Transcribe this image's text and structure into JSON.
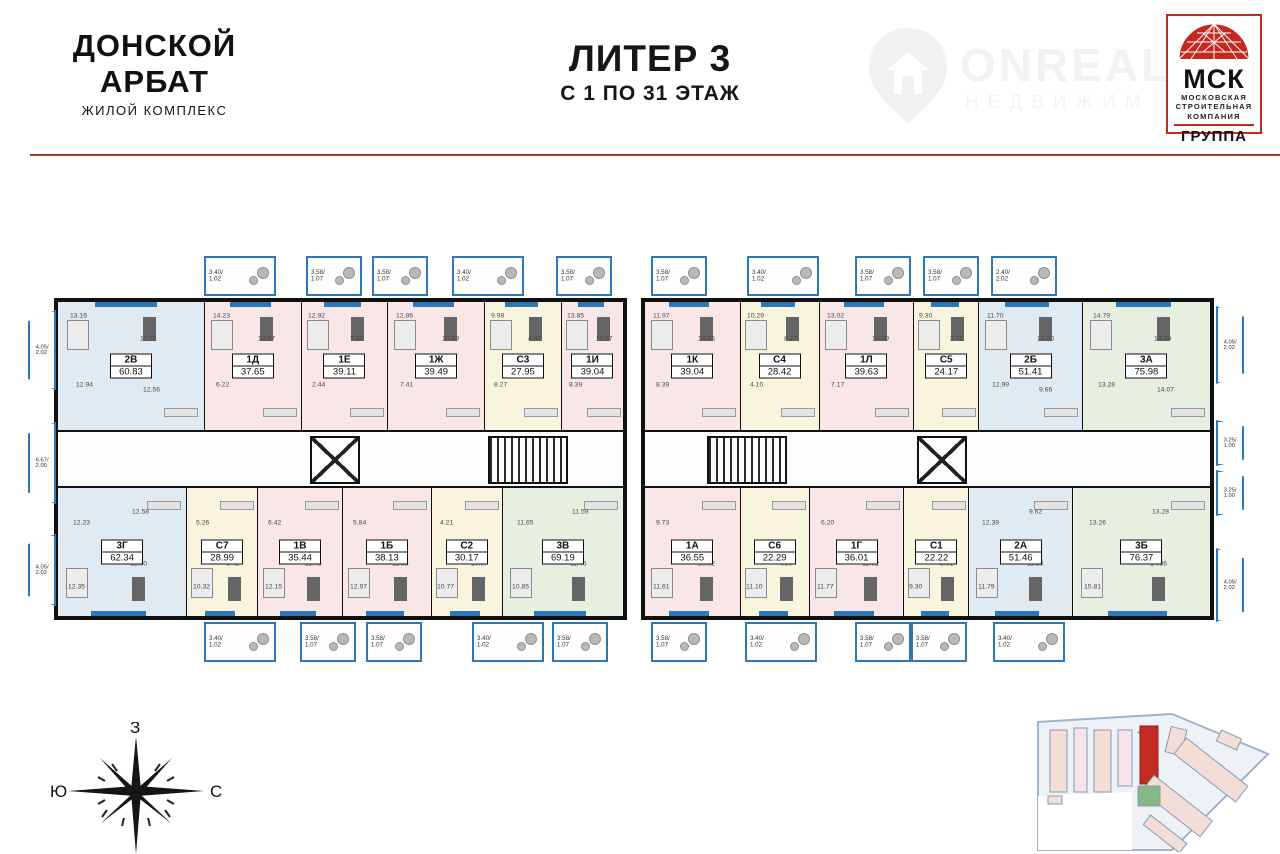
{
  "header": {
    "brand": {
      "line1": "ДОНСКОЙ",
      "line2": "АРБАТ",
      "subtitle": "ЖИЛОЙ КОМПЛЕКС"
    },
    "title": {
      "main": "ЛИТЕР 3",
      "sub": "С 1 ПО 31 ЭТАЖ"
    },
    "watermark": {
      "big": "ONREAL",
      "small": "НЕДВИЖИМ"
    },
    "msk": {
      "abbr": "МСК",
      "line1": "МОСКОВСКАЯ",
      "line2": "СТРОИТЕЛЬНАЯ",
      "line3": "КОМПАНИЯ",
      "group": "ГРУППА"
    }
  },
  "floorplan": {
    "accent_wall": "#111111",
    "window_color": "#2b77b8",
    "unit_colors": {
      "one_room": "#f9e6e6",
      "two_room": "#dfeaf2",
      "studio": "#f9f4dd",
      "three_room": "#e7f0e0"
    },
    "wings": [
      {
        "side": "left",
        "top_units": [
          {
            "code": "2В",
            "area": "60.83",
            "color": "#dfeaf2",
            "rooms": [
              "13.16",
              "11.55",
              "12.94",
              "12.56"
            ]
          },
          {
            "code": "1Д",
            "area": "37.65",
            "color": "#f9e6e6",
            "rooms": [
              "14.23",
              "12.07",
              "6.22"
            ]
          },
          {
            "code": "1Е",
            "area": "39.11",
            "color": "#f9e6e6",
            "rooms": [
              "12.92",
              "7.40",
              "2.44"
            ]
          },
          {
            "code": "1Ж",
            "area": "39.49",
            "color": "#f9e6e6",
            "rooms": [
              "12.86",
              "10.89",
              "7.41"
            ]
          },
          {
            "code": "С3",
            "area": "27.95",
            "color": "#f9f4dd",
            "rooms": [
              "9.98",
              "4.37",
              "8.27"
            ]
          },
          {
            "code": "1И",
            "area": "39.04",
            "color": "#f9e6e6",
            "rooms": [
              "13.85",
              "11.97",
              "8.39"
            ]
          }
        ],
        "bottom_units": [
          {
            "code": "3Г",
            "area": "62.34",
            "color": "#dfeaf2",
            "rooms": [
              "12.35",
              "12.80",
              "12.23",
              "12.58"
            ]
          },
          {
            "code": "С7",
            "area": "28.99",
            "color": "#f9f4dd",
            "rooms": [
              "10.32",
              "6.42",
              "5.26"
            ]
          },
          {
            "code": "1В",
            "area": "35.44",
            "color": "#f9e6e6",
            "rooms": [
              "12.15",
              "11.48",
              "6.42"
            ]
          },
          {
            "code": "1Б",
            "area": "38.13",
            "color": "#f9e6e6",
            "rooms": [
              "12.97",
              "11.65",
              "5.84"
            ]
          },
          {
            "code": "С2",
            "area": "30.17",
            "color": "#f9f4dd",
            "rooms": [
              "10.77",
              "10.07",
              "4.21"
            ]
          },
          {
            "code": "3В",
            "area": "69.19",
            "color": "#e7f0e0",
            "rooms": [
              "10.85",
              "11.46",
              "11.65",
              "11.59"
            ]
          }
        ],
        "top_balconies": [
          "3.40/1.02",
          "3.58/1.07",
          "3.58/1.07",
          "3.40/1.02",
          "3.58/1.07"
        ],
        "bottom_balconies": [
          "3.40/1.02",
          "3.58/1.07",
          "3.58/1.07",
          "3.40/1.02",
          "3.58/1.07"
        ]
      },
      {
        "side": "right",
        "top_units": [
          {
            "code": "1К",
            "area": "39.04",
            "color": "#f9e6e6",
            "rooms": [
              "11.97",
              "13.85",
              "8.39"
            ]
          },
          {
            "code": "С4",
            "area": "28.42",
            "color": "#f9f4dd",
            "rooms": [
              "10.29",
              "8.27",
              "4.10"
            ]
          },
          {
            "code": "1Л",
            "area": "39.63",
            "color": "#f9e6e6",
            "rooms": [
              "13.02",
              "10.89",
              "7.17"
            ]
          },
          {
            "code": "С5",
            "area": "24.17",
            "color": "#f9f4dd",
            "rooms": [
              "9.30",
              "3.75"
            ]
          },
          {
            "code": "2Б",
            "area": "51.41",
            "color": "#dfeaf2",
            "rooms": [
              "11.70",
              "13.30",
              "12.99",
              "9.66"
            ]
          },
          {
            "code": "3А",
            "area": "75.98",
            "color": "#e7f0e0",
            "rooms": [
              "14.79",
              "14.30",
              "13.28",
              "14.07"
            ]
          }
        ],
        "bottom_units": [
          {
            "code": "1А",
            "area": "36.55",
            "color": "#f9e6e6",
            "rooms": [
              "11.61",
              "10.92",
              "9.73"
            ]
          },
          {
            "code": "С6",
            "area": "22.29",
            "color": "#f9f4dd",
            "rooms": [
              "11.10",
              "4.50"
            ]
          },
          {
            "code": "1Г",
            "area": "36.01",
            "color": "#f9e6e6",
            "rooms": [
              "11.77",
              "12.92",
              "6.20"
            ]
          },
          {
            "code": "С1",
            "area": "22.22",
            "color": "#f9f4dd",
            "rooms": [
              "9.30",
              "3.91"
            ]
          },
          {
            "code": "2А",
            "area": "51.46",
            "color": "#dfeaf2",
            "rooms": [
              "11.79",
              "11.36",
              "12.39",
              "9.62"
            ]
          },
          {
            "code": "3Б",
            "area": "76.37",
            "color": "#e7f0e0",
            "rooms": [
              "15.81",
              "14.36",
              "13.26",
              "13.28"
            ]
          }
        ],
        "top_balconies": [
          "3.58/1.07",
          "3.40/1.02",
          "3.58/1.07",
          "3.58/1.07",
          "2.40/2.02"
        ],
        "bottom_balconies": [
          "3.58/1.07",
          "3.40/1.02",
          "3.58/1.07",
          "3.58/1.07",
          "3.40/1.02"
        ]
      }
    ],
    "edge_balconies": {
      "left": [
        "4.05/2.02",
        "6.67/2.00",
        "4.05/2.02"
      ],
      "right": [
        "4.05/2.02",
        "3.25/1.00",
        "3.25/1.00",
        "4.05/2.02"
      ]
    }
  },
  "compass": {
    "top": "З",
    "left": "Ю",
    "right": "С"
  },
  "siteplan": {
    "highlight": "#c32a22",
    "building_fill": "#f2ded6",
    "green": "#86b886"
  }
}
